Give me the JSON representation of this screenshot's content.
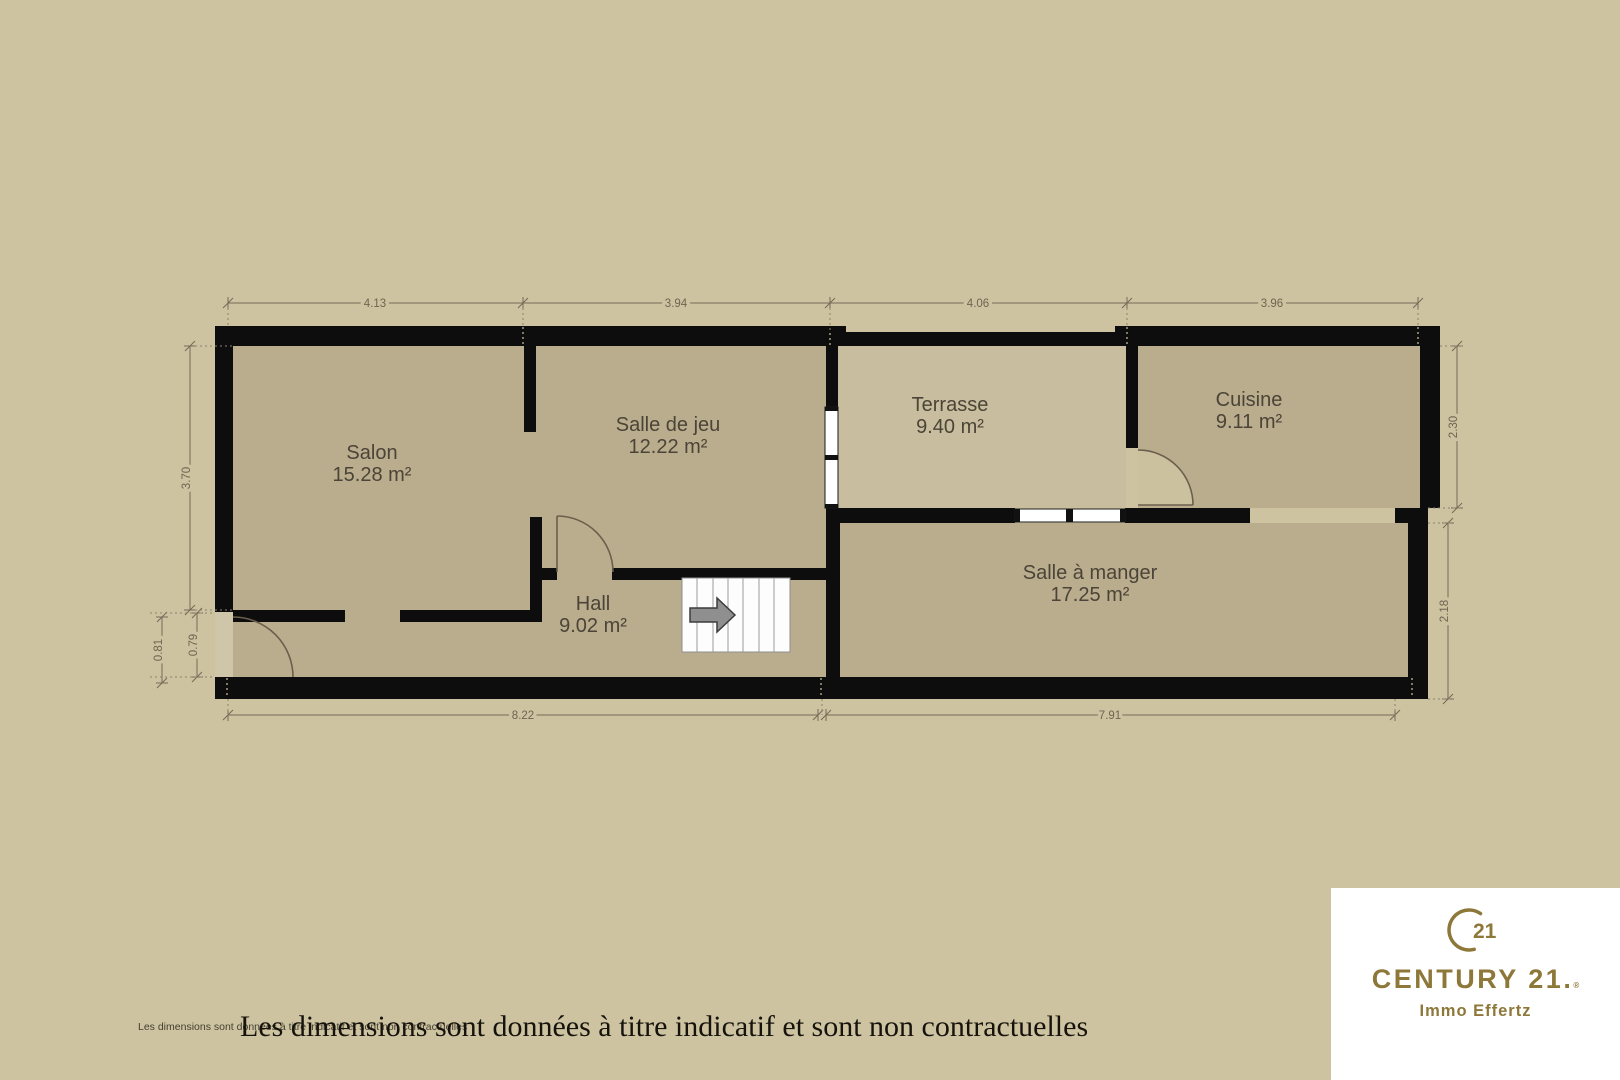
{
  "plan": {
    "rooms": [
      {
        "name": "Salon",
        "area": "15.28 m²"
      },
      {
        "name": "Salle de jeu",
        "area": "12.22 m²"
      },
      {
        "name": "Terrasse",
        "area": "9.40 m²"
      },
      {
        "name": "Cuisine",
        "area": "9.11 m²"
      },
      {
        "name": "Hall",
        "area": "9.02 m²"
      },
      {
        "name": "Salle à manger",
        "area": "17.25 m²"
      }
    ],
    "dimensions": {
      "top": [
        "4.13",
        "3.94",
        "4.06",
        "3.96"
      ],
      "bottom": [
        "8.22",
        "7.91"
      ],
      "left": [
        "3.70",
        "0.81",
        "0.79"
      ],
      "right": [
        "2.30",
        "2.18"
      ]
    },
    "colors": {
      "background": "#cdc3a0",
      "room_fill": "#b9ad8e",
      "terrace_fill": "#c8be9f",
      "wall": "#0d0d0d",
      "dimension_text": "#6e6553",
      "label_text": "#4b4437",
      "brand_gold": "#8d7839",
      "stairs_arrow": "#8f8f8f"
    }
  },
  "footer": {
    "disclaimer_small": "Les dimensions sont données à titre indicatif et sont non contractuelles",
    "disclaimer_large": "Les dimensions sont données à titre indicatif et sont non contractuelles"
  },
  "brand": {
    "seal_number": "21",
    "name": "CENTURY 21.",
    "registered": "®",
    "subtitle": "Immo Effertz"
  }
}
